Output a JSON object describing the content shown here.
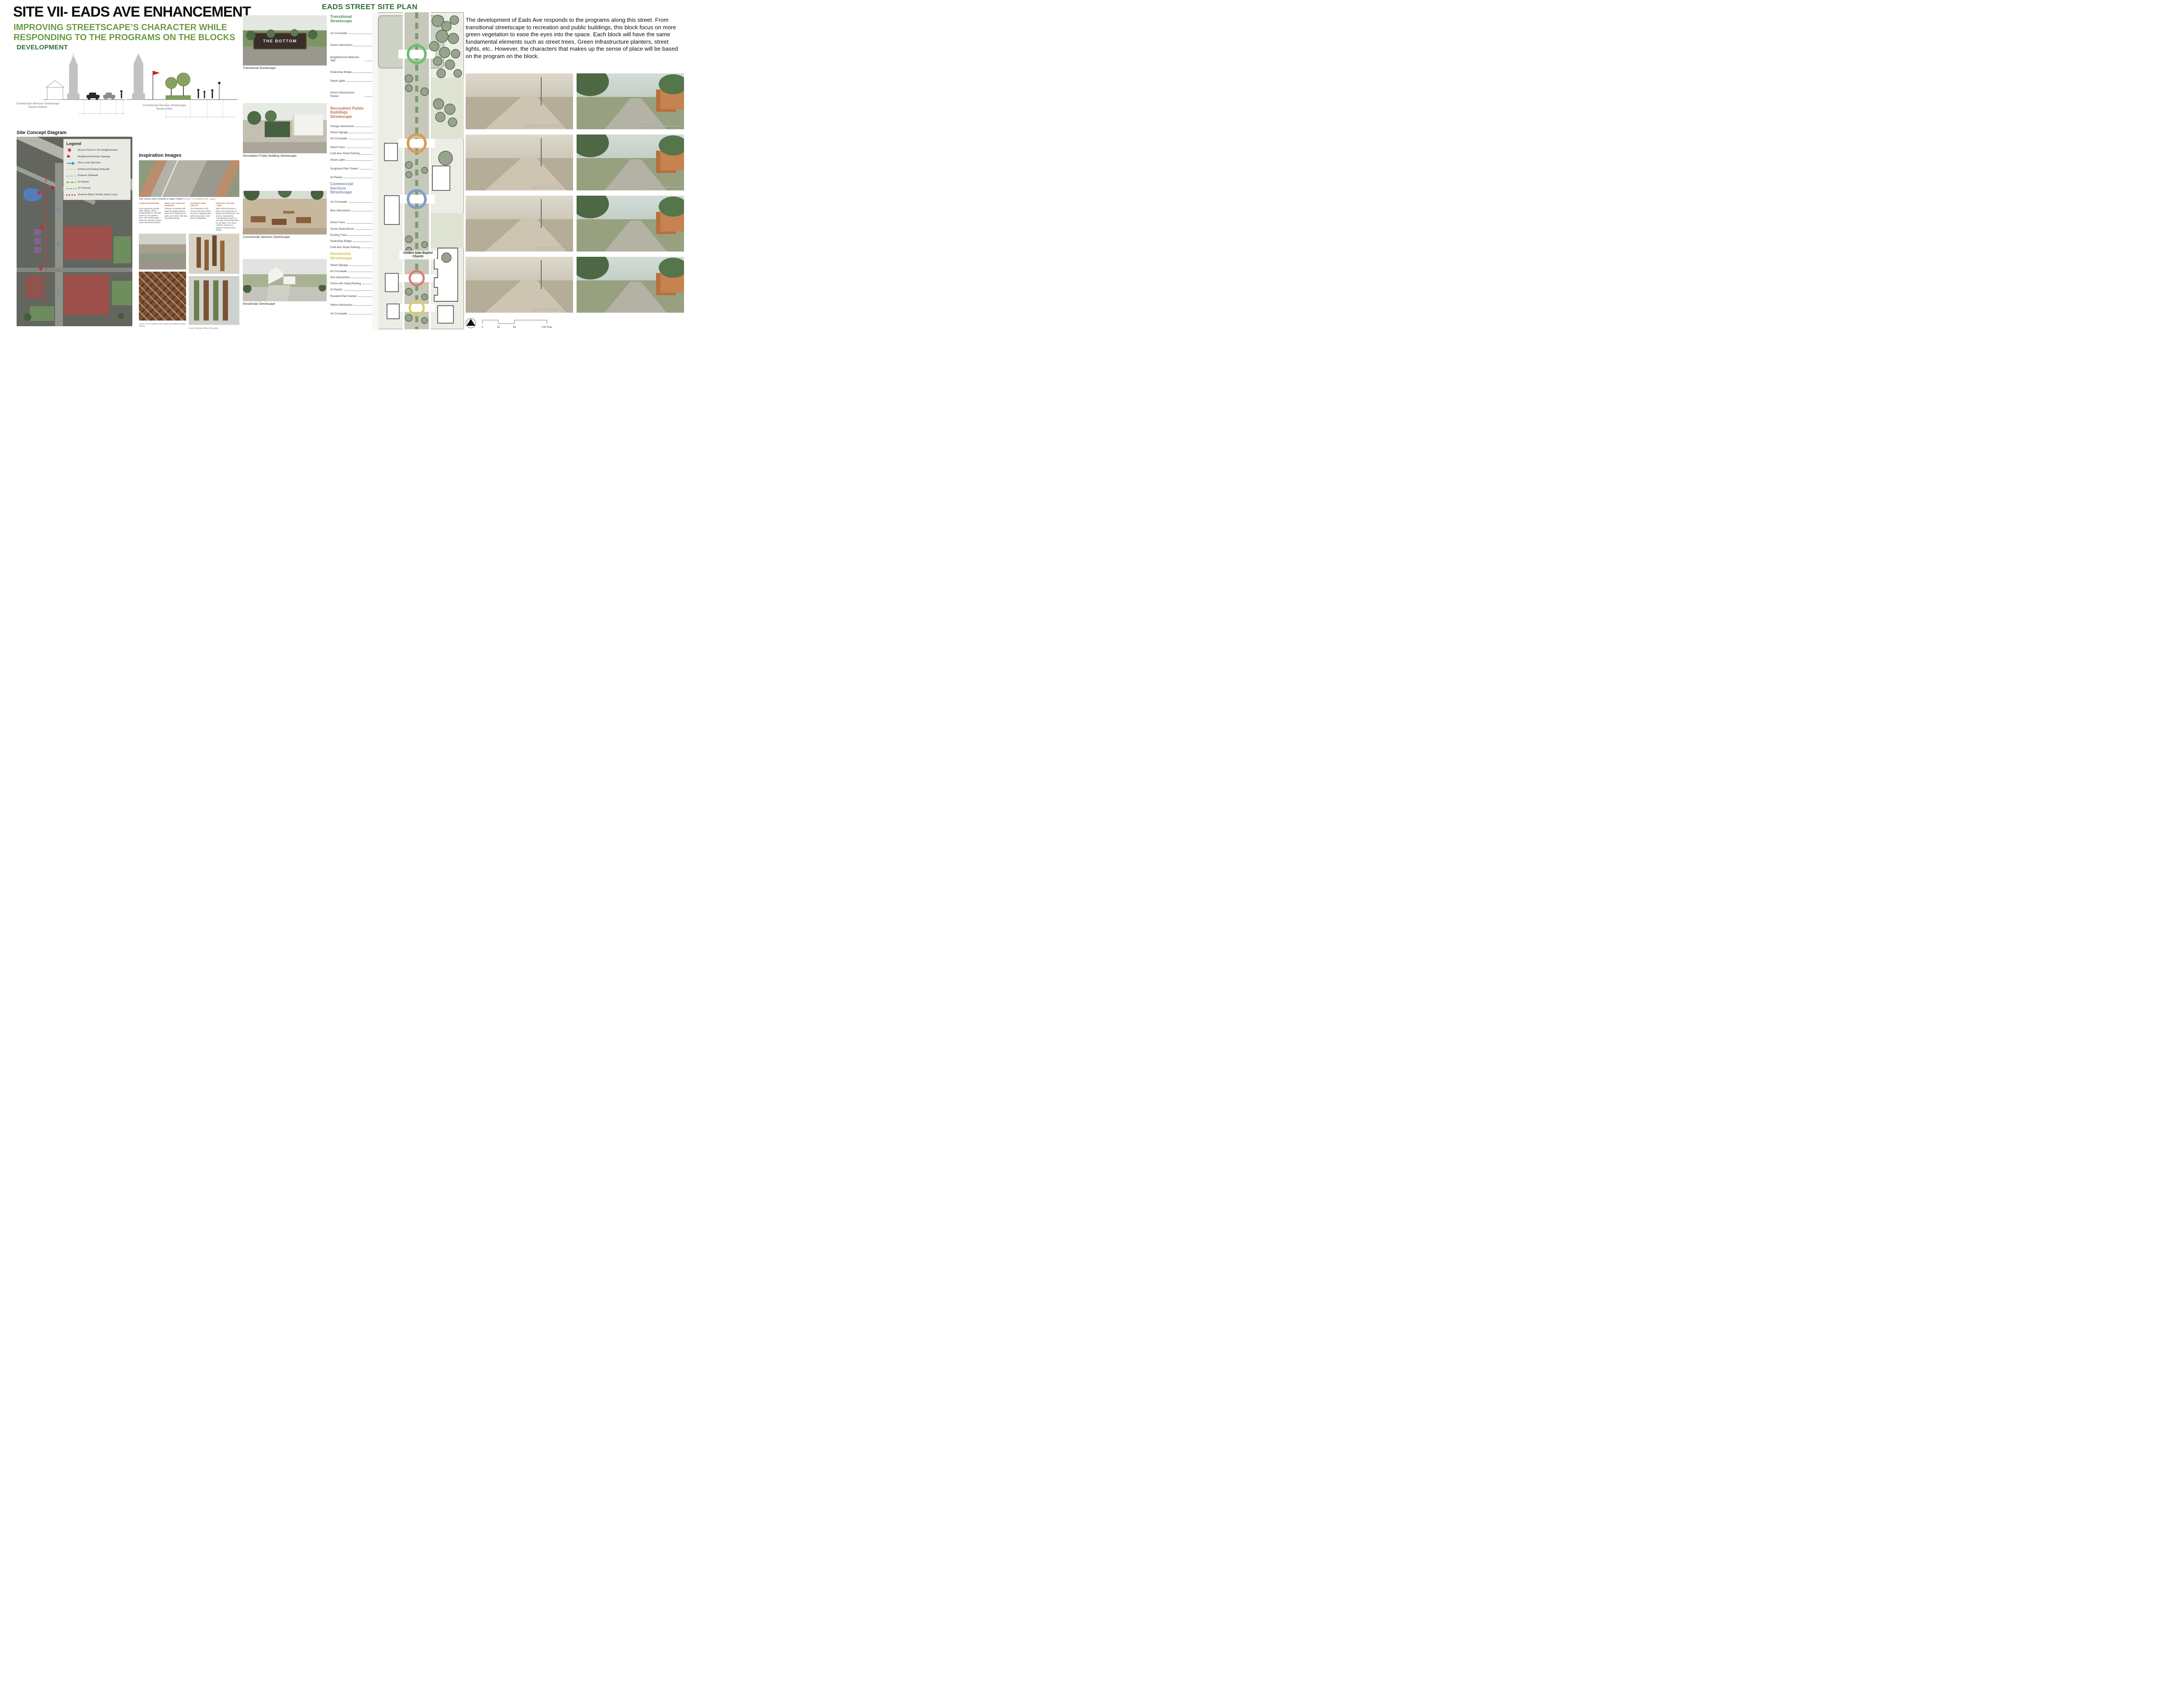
{
  "header": {
    "title": "SITE VII- EADS AVE ENHANCEMENT",
    "subtitle": "IMPROVING STREETSCAPE’S CHARACTER WHILE RESPONDING TO THE PROGRAMS ON THE BLOCKS",
    "development_label": "DEVELOPMENT",
    "accent_green": "#6a9a40",
    "heading_green": "#2e6b33"
  },
  "sections": {
    "before_label": "Commercial/ Services Streetscape Section Before",
    "after_label": "Commercial/ Services Streetscape Section After"
  },
  "site_concept": {
    "heading": "Site Concept Diagram",
    "legend": {
      "title": "Legend",
      "items": [
        {
          "icon": "ic-ast",
          "color": "#e8192c",
          "label": "Access Point To The Neighborhood"
        },
        {
          "icon": "ic-tri",
          "color": "#c32026",
          "label": "Neighborhood Entry Signage"
        },
        {
          "icon": "ic-arrow",
          "color": "#3f8fd2",
          "label": "Drive Lane Direction"
        },
        {
          "icon": "ic-dashy",
          "color": "#e0da3a",
          "label": "Enhanced Existing Sidewalk"
        },
        {
          "icon": "ic-dashg",
          "color": "#b9c4b9",
          "label": "Propose Sidewalk"
        },
        {
          "icon": "ic-dashgr",
          "color": "#7dc242",
          "label": "GI Planter"
        },
        {
          "icon": "ic-dotg",
          "color": "#4e7938",
          "label": "GI Treewell"
        },
        {
          "icon": "ic-dotr",
          "color": "#d42027",
          "label": "Sharrow (Bike/ Vehicle share Lane)"
        }
      ]
    }
  },
  "inspiration": {
    "heading": "Inspiration Images",
    "vision_caption": "THE VISION, 25TH AVENUE & AMES STREET",
    "vision_source": "Source: The Mobility Plan - page 3",
    "columns": [
      {
        "heading": "CURB EXTENSIONS",
        "body": "Curb extensions provide safer parking, narrow driving distances, and add space for rain gardens, trees, other landscaping elements, benches, bicycle racks, and street furniture."
      },
      {
        "heading": "HEAD OUT ANGLED PARKING",
        "body": "Parking is increased with head out angled parking, which is the safest way to park a car and the first step of parallel parking."
      },
      {
        "heading": "GATEWAY MINI-CIRCLE",
        "body": "The intersection at 25 Avenue and Ames Street becomes a gateway that welcomes people to the heart of Edgewater."
      },
      {
        "heading": "ONE-WAY TRAVEL LANE",
        "body": "25th Avenue becomes a place more supportive of people and businesses. The street is narrowed by converting the street to a one-way, 10 foot travel lane for one block. The street could be curb-less to support a festival street design."
      }
    ],
    "sources": [
      "Source: The Principals, Drew Seskunas Modular Planter System",
      "Source: Modular Planter Placement"
    ]
  },
  "middle": {
    "renderings": [
      {
        "caption": "Transitional Streetscape",
        "sign_text": "THE BOTTOM"
      },
      {
        "caption": "Recreation/ Public Building Streetscape"
      },
      {
        "caption": "Commercial/ Services Streetscape"
      },
      {
        "caption": "Residential Streetscape"
      }
    ]
  },
  "site_plan": {
    "heading": "EADS STREET SITE PLAN",
    "church_label": "Golden Gate Baptist Church",
    "scale_ticks": [
      "0",
      "25",
      "50",
      "100 Feet"
    ],
    "group_colors": {
      "transitional": "#4a8b52",
      "recreation": "#b5724a",
      "commercial": "#7f8aa8",
      "residential": "#d3c24a"
    },
    "rows": [
      {
        "label": "Transitional Streetscape",
        "cls": "hd hg m0"
      },
      {
        "label": "Art Crosswalk",
        "cls": "it mC"
      },
      {
        "label": "Green Intersection",
        "cls": "it mC"
      },
      {
        "label": "Neighborhood Welcome Sign",
        "cls": "it mC"
      },
      {
        "label": "Pedestrian Bridge",
        "cls": "it mC"
      },
      {
        "label": "Street Lights",
        "cls": "it mB"
      },
      {
        "label": "Green Infrastructure Planter",
        "cls": "it mC"
      },
      {
        "label": "Recreation/ Public Buildings Streetscape",
        "cls": "hd ho mC"
      },
      {
        "label": "Orange Intersection",
        "cls": "it mB"
      },
      {
        "label": "Street Signage",
        "cls": "it mA"
      },
      {
        "label": "Art Crosswalk",
        "cls": "it mA"
      },
      {
        "label": "Street Trees",
        "cls": "it mB"
      },
      {
        "label": "Curb-less Street Parking",
        "cls": "it mA"
      },
      {
        "label": "Street Lights",
        "cls": "it mA"
      },
      {
        "label": "Sculptural Plant Towers",
        "cls": "it mB"
      },
      {
        "label": "GI Planter",
        "cls": "it mB"
      },
      {
        "label": "Commercial/ Services Streetscape",
        "cls": "hd hb mA"
      },
      {
        "label": "Art Crosswalk",
        "cls": "it mB"
      },
      {
        "label": "Blue Intersection",
        "cls": "it mB"
      },
      {
        "label": "Street Trees",
        "cls": "it mC"
      },
      {
        "label": "Social Street Bench",
        "cls": "it mA"
      },
      {
        "label": "Existing Trees",
        "cls": "it mA"
      },
      {
        "label": "Pedestrian Bridge",
        "cls": "it mA"
      },
      {
        "label": "Curb-less Street Parking",
        "cls": "it mA"
      },
      {
        "label": "Residential Streetscape",
        "cls": "hd hy mA"
      },
      {
        "label": "Street Signage",
        "cls": "it mA"
      },
      {
        "label": "Art Crosswalk",
        "cls": "it mA"
      },
      {
        "label": "Red Intersection",
        "cls": "it mA"
      },
      {
        "label": "Fence with Hang Planting",
        "cls": "it mA"
      },
      {
        "label": "GI Planter",
        "cls": "it mA"
      },
      {
        "label": "Resident Rain Garden",
        "cls": "it mA"
      },
      {
        "label": "Yellow Intersection",
        "cls": "it mB"
      },
      {
        "label": "Art Crosswalk",
        "cls": "it mB"
      }
    ]
  },
  "right_panel": {
    "paragraph": "The development of Eads Ave responds to the programs along this street. From transitional streetscape to recreation and public buildings, this block focus on more green vegetation to ease the eyes into the space. Each block will have the same fundamental elements such as street trees, Green Infrastructure planters, street lights, etc.. However, the characters that makes up the sense of place will be based on the program on the block.",
    "photos": [
      {
        "caption": "COLORADO BLVD AND EADS ST. BEFORE",
        "type": "before"
      },
      {
        "caption": "COLORADO BLVD AND EADS ST. AFTER",
        "type": "after"
      },
      {
        "caption": "COMAL ST AND EADS ST. BEFORE",
        "type": "before"
      },
      {
        "caption": "COMAL ST AND EADS ST. AFTER",
        "type": "after"
      },
      {
        "caption": "DODD ST AND EADS ST. BEFORE",
        "type": "before"
      },
      {
        "caption": "",
        "type": "after"
      },
      {
        "caption": "EADS ST FACING NORTH: BEFORE",
        "type": "before"
      },
      {
        "caption": "",
        "type": "after"
      }
    ]
  }
}
